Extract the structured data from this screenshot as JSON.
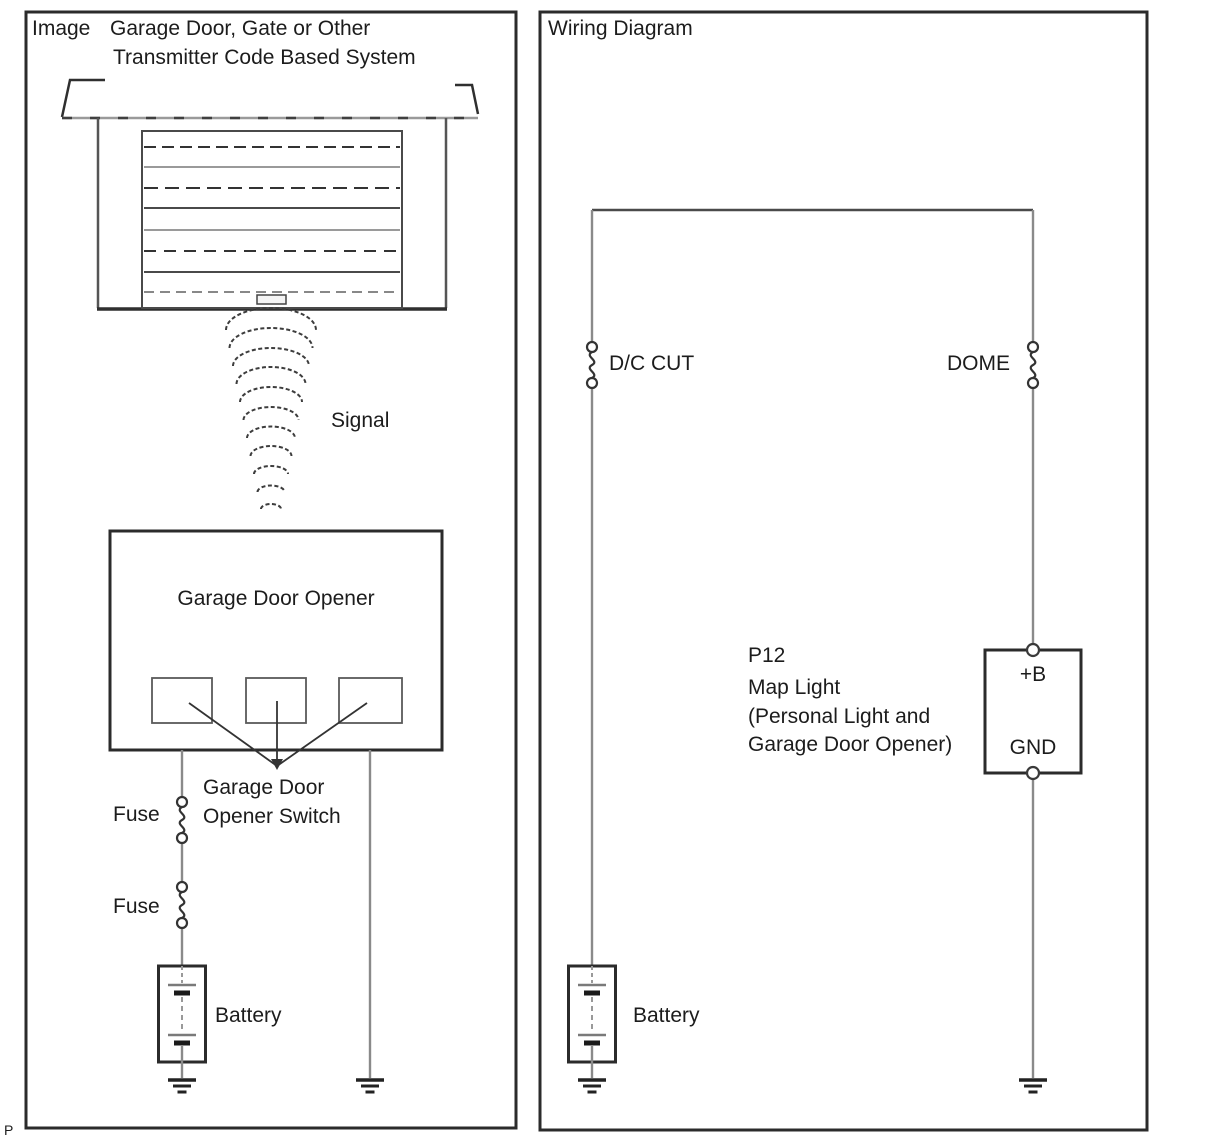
{
  "left_panel": {
    "label": "Image",
    "title_line1": "Garage Door, Gate or Other",
    "title_line2": "Transmitter Code Based System",
    "signal_label": "Signal",
    "opener_label": "Garage Door Opener",
    "switch_line1": "Garage Door",
    "switch_line2": "Opener Switch",
    "fuse_top_label": "Fuse",
    "fuse_bottom_label": "Fuse",
    "battery_label": "Battery"
  },
  "right_panel": {
    "title": "Wiring Diagram",
    "fuse_dc_label": "D/C CUT",
    "fuse_dome_label": "DOME",
    "connector": {
      "ref": "P12",
      "name": "Map Light",
      "desc_line1": "(Personal Light and",
      "desc_line2": "Garage Door Opener)",
      "terminal_power": "+B",
      "terminal_ground": "GND"
    },
    "battery_label": "Battery"
  },
  "page_marker": "P",
  "colors": {
    "line": "#2b2b2b",
    "wire": "#8a8a8a",
    "text": "#1c1c1c",
    "background": "#ffffff"
  }
}
